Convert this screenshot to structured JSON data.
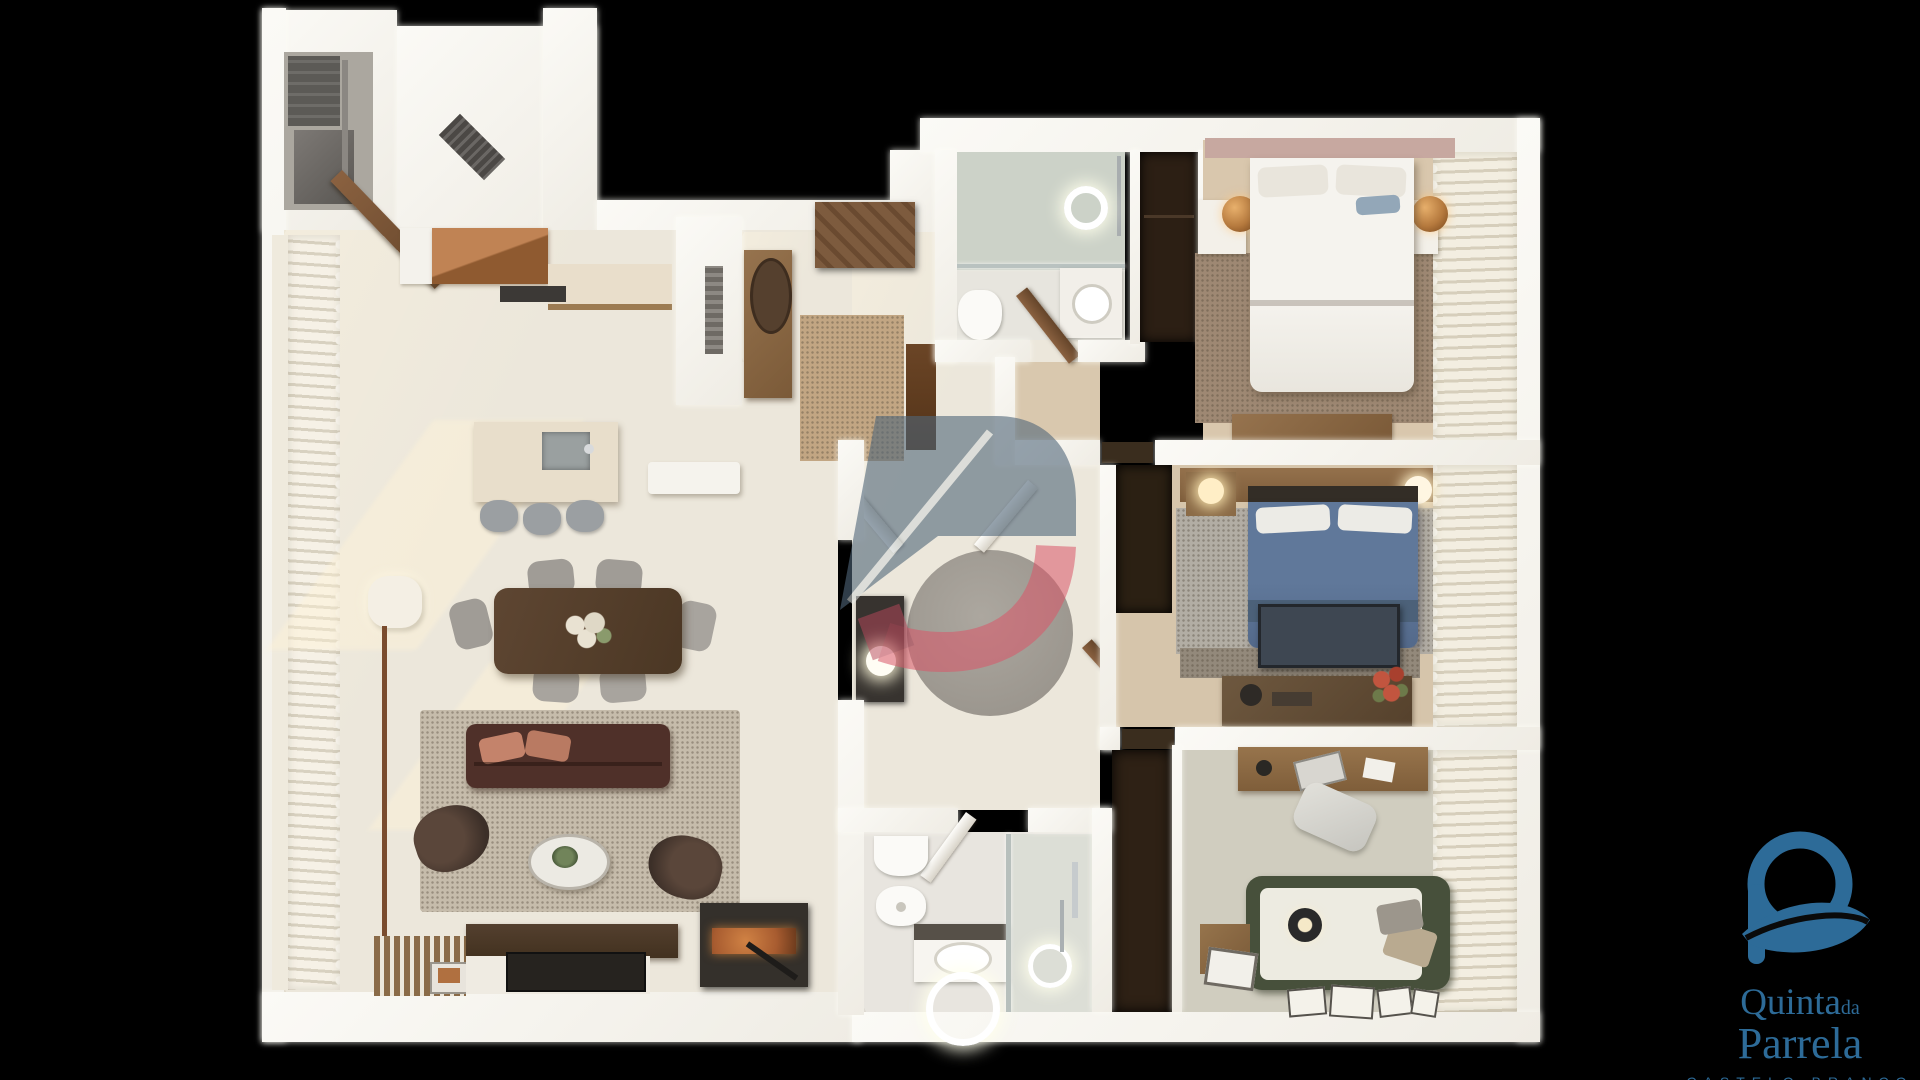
{
  "image_type": "3d-rendered apartment floor plan (top-down render on black background)",
  "background_color": "#000000",
  "branding": {
    "mark": "circle-leaf-Q-monogram",
    "word1": "Quinta",
    "word1_small": "da",
    "word2": "Parrela",
    "tagline": "CASTELO BRANCO",
    "color": "#2d6b98"
  },
  "watermark": {
    "shape": "house-with-D real-estate logo, semi-transparent",
    "roof_color": "#51677a",
    "d_color": "#d95668",
    "opacity": 0.6
  },
  "palette": {
    "wall": "#f8f6f1",
    "marble_floor": "#ece7db",
    "bedroom_carpet": "#9e8873",
    "bedroom_floor": "#d8c6ac",
    "blue_bed": "#5a7290",
    "sofa": "#4f3029",
    "dining_table": "#57402e",
    "kitchen_island": "#e8decb",
    "copper_cabinet": "#a96f42",
    "daybed_green": "#47503b",
    "shower_tile": "#ccd2c8"
  },
  "scene": {
    "rooms": [
      "utility-room",
      "kitchen",
      "living-dining-room",
      "entry-hall",
      "hallway",
      "ensuite-bathroom",
      "master-bedroom",
      "second-bedroom",
      "office-bedroom",
      "family-bathroom"
    ],
    "furniture_counts": {
      "dining_chairs": 6,
      "bar_stools": 3,
      "double_beds": 2,
      "daybeds": 1,
      "bathrooms": 2,
      "armchairs": 2,
      "sofas": 1
    }
  }
}
